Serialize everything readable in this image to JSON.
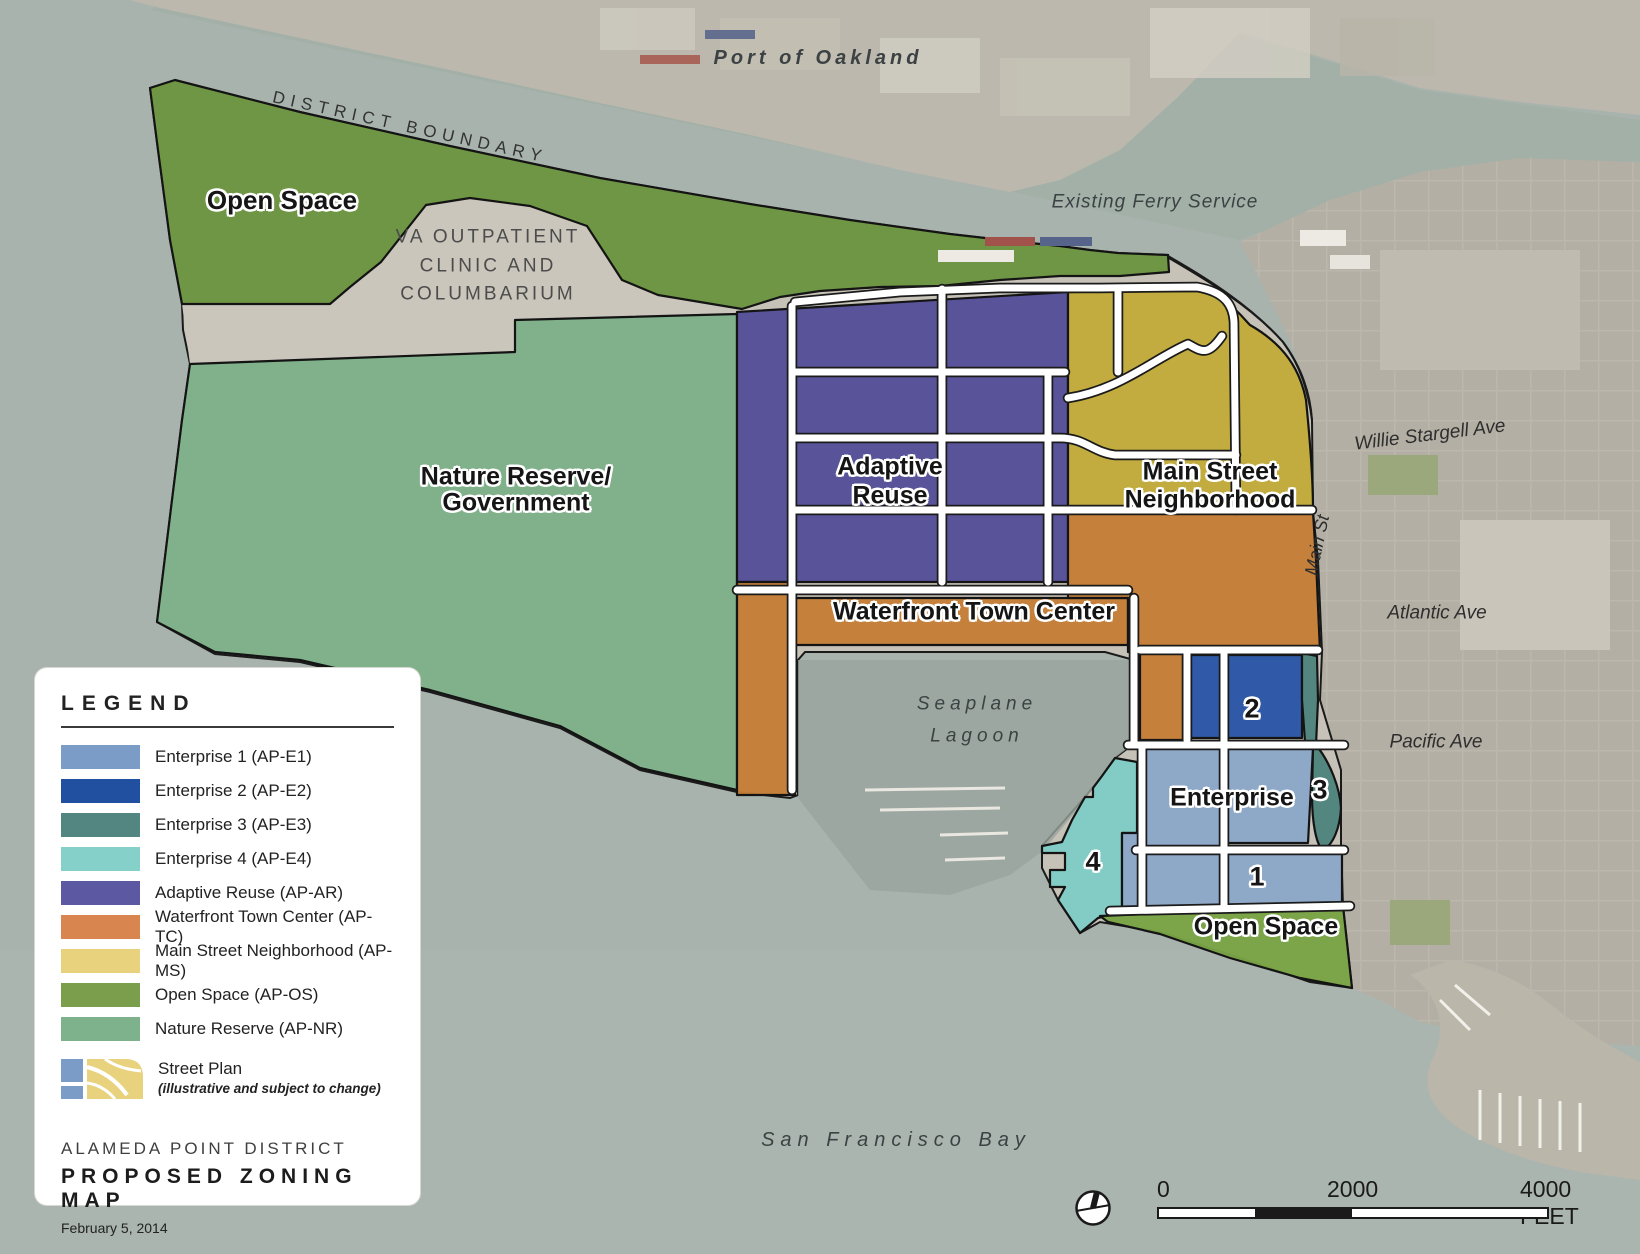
{
  "title_block": {
    "district": "ALAMEDA POINT DISTRICT",
    "title": "PROPOSED ZONING MAP",
    "date": "February 5, 2014"
  },
  "legend": {
    "title": "LEGEND",
    "items": [
      {
        "label": "Enterprise 1 (AP-E1)",
        "color": "#7b9cc7"
      },
      {
        "label": "Enterprise 2 (AP-E2)",
        "color": "#2150a0"
      },
      {
        "label": "Enterprise 3 (AP-E3)",
        "color": "#538680"
      },
      {
        "label": "Enterprise 4 (AP-E4)",
        "color": "#85d1ca"
      },
      {
        "label": "Adaptive Reuse (AP-AR)",
        "color": "#5d58a2"
      },
      {
        "label": "Waterfront Town Center (AP-TC)",
        "color": "#d8854f"
      },
      {
        "label": "Main Street Neighborhood (AP-MS)",
        "color": "#e9d27d"
      },
      {
        "label": "Open Space (AP-OS)",
        "color": "#7b9e4d"
      },
      {
        "label": "Nature Reserve (AP-NR)",
        "color": "#7eb28c"
      }
    ],
    "street_plan": {
      "label": "Street Plan",
      "note": "(illustrative and subject to change)"
    }
  },
  "scale_bar": {
    "t0": "0",
    "t1": "2000",
    "t2": "4000 FEET"
  },
  "map_labels": {
    "port": "Port of Oakland",
    "boundary": "DISTRICT BOUNDARY",
    "os_north": "Open Space",
    "va1": "VA OUTPATIENT",
    "va2": "CLINIC AND",
    "va3": "COLUMBARIUM",
    "ferry": "Existing Ferry Service",
    "nr1": "Nature Reserve/",
    "nr2": "Government",
    "ar1": "Adaptive",
    "ar2": "Reuse",
    "ms1": "Main Street",
    "ms2": "Neighborhood",
    "tc": "Waterfront Town Center",
    "stargell": "Willie Stargell Ave",
    "main_st": "Main St",
    "atlantic": "Atlantic Ave",
    "sea1": "Seaplane",
    "sea2": "Lagoon",
    "pacific": "Pacific Ave",
    "enterprise": "Enterprise",
    "n1": "1",
    "n2": "2",
    "n3": "3",
    "n4": "4",
    "os_south": "Open Space",
    "bay": "San Francisco Bay"
  },
  "colors": {
    "water": "#a9b3ad",
    "estuary": "#9cada2",
    "lagoon": "#98a49e",
    "bay_light": "#aeb8b2",
    "land_far": "#bcb8ad",
    "land_city": "#b3afa4",
    "land_base": "#c6c2b7",
    "land_va": "#cac6bc",
    "marina": "#bab6aa",
    "ap_os": "#6b9440",
    "ap_os_s": "#79a245",
    "ap_nr": "#7cb088",
    "ap_ar": "#534e98",
    "ap_ms": "#c2ab38",
    "ap_tc": "#c57e36",
    "ap_e1": "#8ba7c8",
    "ap_e2": "#2a55a7",
    "ap_e3": "#4f837e",
    "ap_e4": "#7fccc6"
  }
}
